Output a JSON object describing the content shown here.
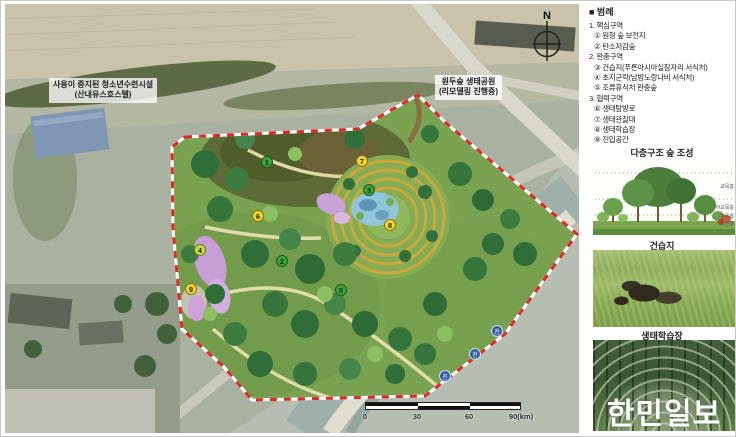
{
  "legend": {
    "rows": [
      {
        "text": "■ 범례",
        "type": "title"
      },
      {
        "text": "1. 핵심구역",
        "type": "group"
      },
      {
        "text": "① 원형 숲 보전지",
        "type": "item"
      },
      {
        "text": "② 탄소저감숲",
        "type": "item"
      },
      {
        "text": "2. 완충구역",
        "type": "group"
      },
      {
        "text": "③ 건습지(푸른아시아실잠자리 서식처)",
        "type": "item"
      },
      {
        "text": "④ 초지군락(남방노랑나비 서식처)",
        "type": "item"
      },
      {
        "text": "⑤ 조류휴식처 완충숲",
        "type": "item"
      },
      {
        "text": "3. 협력구역",
        "type": "group"
      },
      {
        "text": "⑥ 생태탐방로",
        "type": "item"
      },
      {
        "text": "⑦ 생태관찰대",
        "type": "item"
      },
      {
        "text": "⑧ 생태학습장",
        "type": "item"
      },
      {
        "text": "⑨ 진입공간",
        "type": "item"
      }
    ]
  },
  "sections": {
    "forest": {
      "title": "다층구조 숲 조성",
      "layers": [
        "교목층",
        "아교목층",
        "관목층",
        "초본층"
      ]
    },
    "wetland": {
      "title": "건습지"
    },
    "eco_learning": {
      "title": "생태학습장"
    }
  },
  "map": {
    "compass": "N",
    "annotations": [
      {
        "lines": [
          "사용이 중지된 청소년수련시설",
          "(산내유스호스텔)"
        ]
      },
      {
        "lines": [
          "원두숲 생태공원",
          "(리모델링 진행중)"
        ]
      }
    ],
    "markers": [
      {
        "num": "1",
        "glyph": "①",
        "x": 262,
        "y": 158,
        "group": "core"
      },
      {
        "num": "2",
        "glyph": "②",
        "x": 277,
        "y": 257,
        "group": "core"
      },
      {
        "num": "3",
        "glyph": "③",
        "x": 364,
        "y": 186,
        "group": "core"
      },
      {
        "num": "4",
        "glyph": "④",
        "x": 195,
        "y": 246,
        "group": "buffer"
      },
      {
        "num": "5",
        "glyph": "⑤",
        "x": 336,
        "y": 286,
        "group": "core"
      },
      {
        "num": "6",
        "glyph": "⑥",
        "x": 253,
        "y": 212,
        "group": "coop"
      },
      {
        "num": "7",
        "glyph": "⑦",
        "x": 357,
        "y": 157,
        "group": "coop"
      },
      {
        "num": "8",
        "glyph": "⑧",
        "x": 385,
        "y": 221,
        "group": "coop"
      },
      {
        "num": "9",
        "glyph": "⑨",
        "x": 186,
        "y": 285,
        "group": "coop"
      }
    ],
    "river_markers": [
      {
        "label": "천",
        "x": 492,
        "y": 327
      },
      {
        "label": "천",
        "x": 470,
        "y": 350
      },
      {
        "label": "천",
        "x": 440,
        "y": 372
      }
    ],
    "scale_bar": {
      "ticks": [
        "0",
        "30",
        "60",
        "90(km)"
      ]
    }
  },
  "watermark": "한민일보",
  "colors": {
    "site_boundary_red": "#e02a2a",
    "marker_core_green": "#3aa33c",
    "marker_coop_yellow": "#f4d628",
    "marker_buffer_yellowgreen": "#cbdc3f",
    "river_marker_blue": "#2c5ea6"
  }
}
